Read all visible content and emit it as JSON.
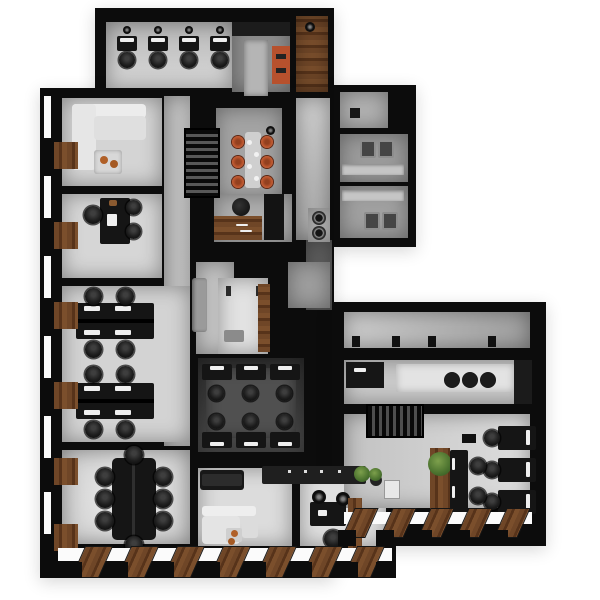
{
  "scene": {
    "kind": "3d-office-floor-plan-top-down-render",
    "background": "#ffffff",
    "visible_text": "none"
  },
  "palette": {
    "wall": "#0c0c0c",
    "floor_light": "#d8d8d8",
    "floor_mid": "#a8a8a8",
    "floor_dark_room": "#3a3a3a",
    "wood": "#6f4627",
    "accent_orange": "#bd5831",
    "plant_green": "#4a712e",
    "sofa_white": "#e9e9e9",
    "sofa_gray": "#9a9a9a",
    "furniture_black": "#151515",
    "glass": "#fbfbfb"
  },
  "rooms": [
    {
      "id": "open-office-top",
      "desks": 4,
      "chairs": 4
    },
    {
      "id": "kitchen-nook-top",
      "orange_lockers": 1,
      "fridge": 1
    },
    {
      "id": "wood-floor-entry",
      "pendant_lights": 1
    },
    {
      "id": "lounge-top-left",
      "white_l_sofa": 1,
      "coffee_table": 1,
      "orange_bowls": 2
    },
    {
      "id": "private-office",
      "desk": 1,
      "executive_chair": 1,
      "guest_chairs": 2
    },
    {
      "id": "open-office-left",
      "desk_clusters": 2,
      "desks_per_cluster": 4,
      "chairs": 8
    },
    {
      "id": "conference-room",
      "table": 1,
      "chairs": 8
    },
    {
      "id": "stairwell-a",
      "treads": "horizontal"
    },
    {
      "id": "cafeteria",
      "table": 1,
      "orange_stools": 6,
      "plates": 4
    },
    {
      "id": "kitchenette",
      "wood_counter": 1,
      "coffee-machine": 1,
      "tall_cabinet": 1
    },
    {
      "id": "phone-booth-zone",
      "gray_sofa": 1,
      "booth_bench": 1,
      "wood_panel": 1
    },
    {
      "id": "team-room-center",
      "desks": 6,
      "chairs": 6
    },
    {
      "id": "laundry-nook",
      "washing_machines": 2
    },
    {
      "id": "wc-small",
      "door_mark": 1
    },
    {
      "id": "restroom-1",
      "toilets": 2,
      "counter": 1
    },
    {
      "id": "restroom-2",
      "toilets": 2,
      "counter": 1
    },
    {
      "id": "corridor-right",
      "door_frames": 4
    },
    {
      "id": "kitchen-right",
      "sinks": 3,
      "appliance_block": 1
    },
    {
      "id": "stairwell-b",
      "treads": "vertical"
    },
    {
      "id": "open-office-right",
      "wall_desks": 3,
      "island_desks": 2,
      "plants": 2,
      "moss_ball": 1,
      "printer": 1,
      "wood_planter": 1
    },
    {
      "id": "lounge-bottom",
      "black_sofa": 1,
      "white_chaise": 1,
      "side_table": 1,
      "orange_bowls": 2
    },
    {
      "id": "office-bottom",
      "desk": 1,
      "chair": 1,
      "pendant_lights": 2,
      "wood_partition": 1
    },
    {
      "id": "bar-counter",
      "stool_dots": 4
    }
  ],
  "windows": {
    "left_glass_y": [
      96,
      176,
      256,
      336,
      416,
      492
    ],
    "left_sill_y": [
      142,
      222,
      302,
      382,
      458,
      524
    ],
    "bottom_left_slat_x": [
      78,
      124,
      170,
      216,
      262,
      308,
      350
    ],
    "bottom_left_pier_x": [
      62,
      108,
      154,
      200,
      246,
      292,
      338,
      376
    ],
    "bottom_right_slat_x": [
      348,
      386,
      424,
      462,
      500
    ],
    "bottom_right_pier_x": [
      338,
      376,
      414,
      452,
      490,
      524
    ]
  }
}
